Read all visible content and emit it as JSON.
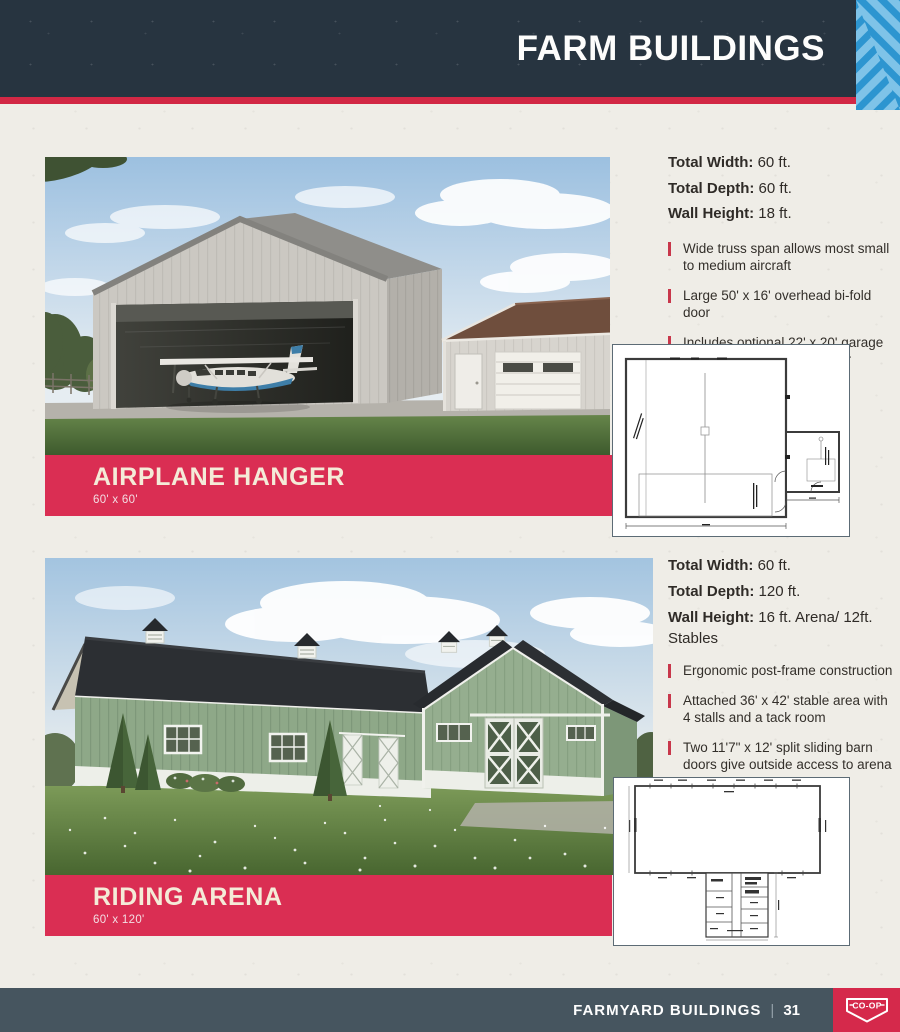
{
  "header": {
    "title": "FARM BUILDINGS"
  },
  "sections": [
    {
      "name": "AIRPLANE HANGER",
      "dimensions": "60' x 60'",
      "specs": [
        {
          "label": "Total Width:",
          "value": "60 ft."
        },
        {
          "label": "Total Depth:",
          "value": "60 ft."
        },
        {
          "label": "Wall Height:",
          "value": "18 ft."
        }
      ],
      "features": [
        "Wide truss span allows most small to medium aircraft",
        "Large 50' x 16' overhead bi-fold door",
        "Includes optional 22' x 20' garage with 10' x 10' overhead door"
      ]
    },
    {
      "name": "RIDING ARENA",
      "dimensions": "60' x 120'",
      "specs": [
        {
          "label": "Total Width:",
          "value": "60 ft."
        },
        {
          "label": "Total Depth:",
          "value": "120 ft."
        },
        {
          "label": "Wall Height:",
          "value": "16 ft. Arena/ 12ft. Stables"
        }
      ],
      "features": [
        "Ergonomic post-frame construction",
        "Attached 36' x 42' stable area with 4 stalls and a tack room",
        "Two 11'7\" x 12' split sliding barn doors give outside access to arena"
      ]
    }
  ],
  "footer": {
    "label": "FARMYARD BUILDINGS",
    "separator": "|",
    "page_number": "31",
    "logo_text": "CO-OP"
  },
  "colors": {
    "header_navy": "#273440",
    "accent_red": "#d22845",
    "banner_red": "#da2e53",
    "banner_title_cream": "#f4ebd8",
    "footer_slate": "#46555f",
    "coop_red": "#d5294b",
    "body_text": "#2f2b27",
    "page_background": "#efede7",
    "pattern_blue_light": "#7fc3e8",
    "pattern_blue_dark": "#2d95d0"
  }
}
